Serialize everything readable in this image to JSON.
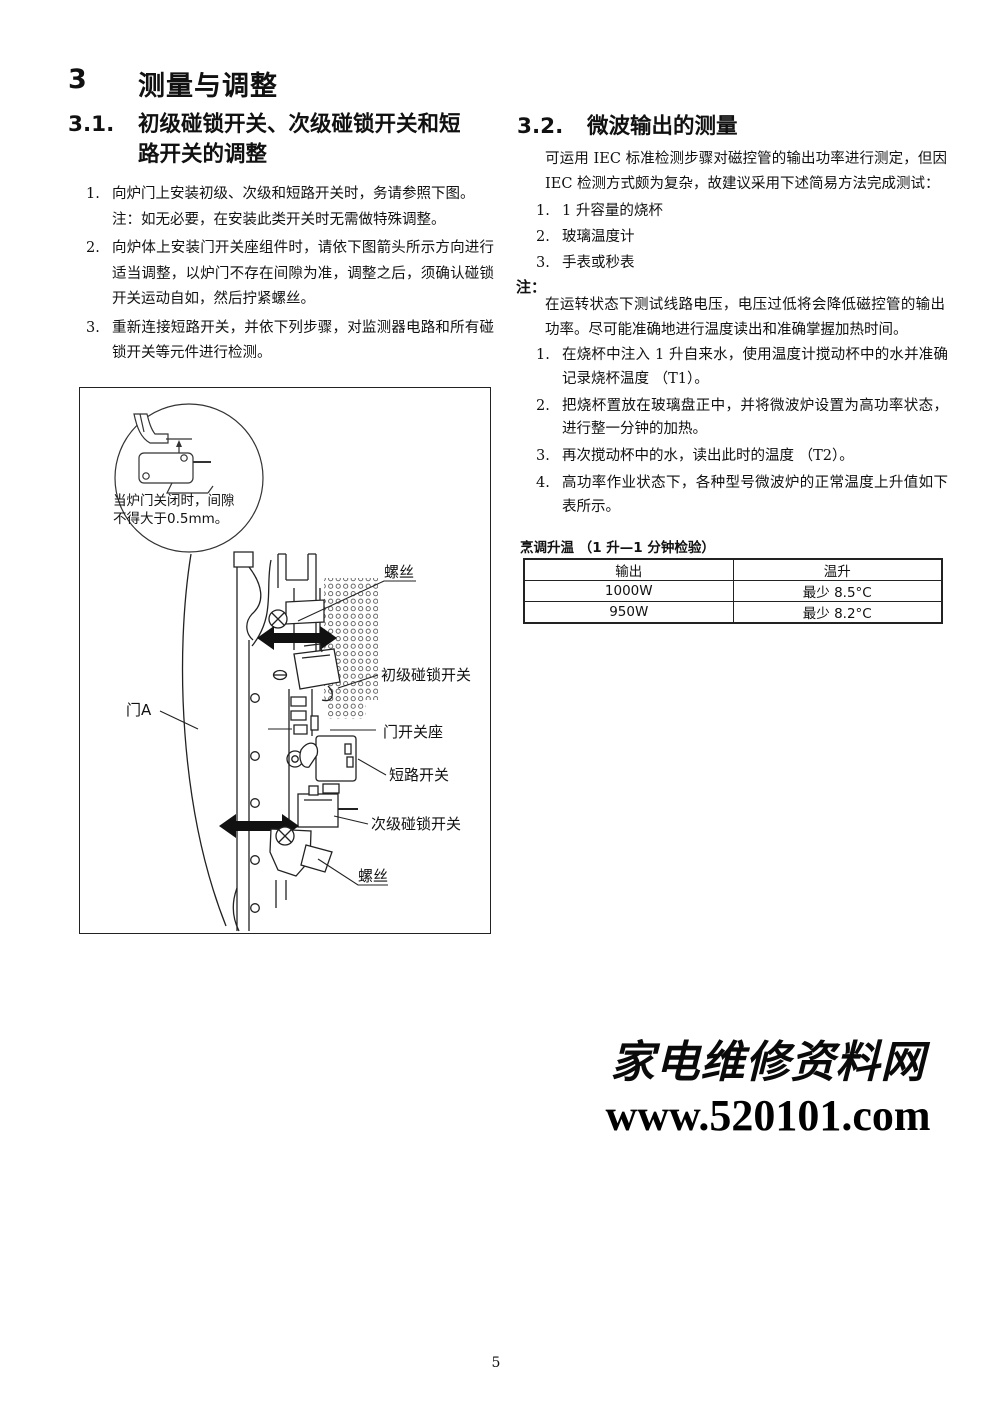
{
  "page": {
    "number": "5"
  },
  "title": {
    "number": "3",
    "text": "测量与调整"
  },
  "section31": {
    "number": "3.1.",
    "heading_line1": "初级碰锁开关、次级碰锁开关和短",
    "heading_line2": "路开关的调整",
    "items": [
      {
        "num": "1.",
        "text": "向炉门上安装初级、次级和短路开关时，务请参照下图。",
        "note": "注：如无必要，在安装此类开关时无需做特殊调整。"
      },
      {
        "num": "2.",
        "text": "向炉体上安装门开关座组件时，请依下图箭头所示方向进行适当调整，以炉门不存在间隙为准，调整之后，须确认碰锁开关运动自如，然后拧紧螺丝。"
      },
      {
        "num": "3.",
        "text": "重新连接短路开关，并依下列步骤，对监测器电路和所有碰锁开关等元件进行检测。"
      }
    ]
  },
  "diagram": {
    "inset_line1": "当炉门关闭时，间隙",
    "inset_line2": "不得大于0.5mm。",
    "labels": {
      "screw_top": "螺丝",
      "primary_latch_switch": "初级碰锁开关",
      "door_switch_holder": "门开关座",
      "short_circuit_switch": "短路开关",
      "secondary_latch_switch": "次级碰锁开关",
      "screw_bottom": "螺丝",
      "door_a": "门A"
    }
  },
  "section32": {
    "number": "3.2.",
    "heading": "微波输出的测量",
    "intro": "可运用 IEC 标准检测步骤对磁控管的输出功率进行测定，但因 IEC 检测方式颇为复杂，故建议采用下述简易方法完成测试：",
    "tools": [
      {
        "num": "1.",
        "text": "1 升容量的烧杯"
      },
      {
        "num": "2.",
        "text": "玻璃温度计"
      },
      {
        "num": "3.",
        "text": "手表或秒表"
      }
    ],
    "note_label": "注：",
    "note_text": "在运转状态下测试线路电压，电压过低将会降低磁控管的输出功率。尽可能准确地进行温度读出和准确掌握加热时间。",
    "steps": [
      {
        "num": "1.",
        "text": "在烧杯中注入 1 升自来水，使用温度计搅动杯中的水并准确记录烧杯温度 （T1）。"
      },
      {
        "num": "2.",
        "text": "把烧杯置放在玻璃盘正中，并将微波炉设置为高功率状态，进行整一分钟的加热。"
      },
      {
        "num": "3.",
        "text": "再次搅动杯中的水，读出此时的温度 （T2）。"
      },
      {
        "num": "4.",
        "text": "高功率作业状态下，各种型号微波炉的正常温度上升值如下表所示。"
      }
    ],
    "table": {
      "caption": "烹调升温 （1 升—1 分钟检验）",
      "headers": [
        "输出",
        "温升"
      ],
      "rows": [
        [
          "1000W",
          "最少 8.5°C"
        ],
        [
          "950W",
          "最少 8.2°C"
        ]
      ]
    }
  },
  "watermark": {
    "line1": "家电维修资料网",
    "line2": "www.520101.com"
  }
}
